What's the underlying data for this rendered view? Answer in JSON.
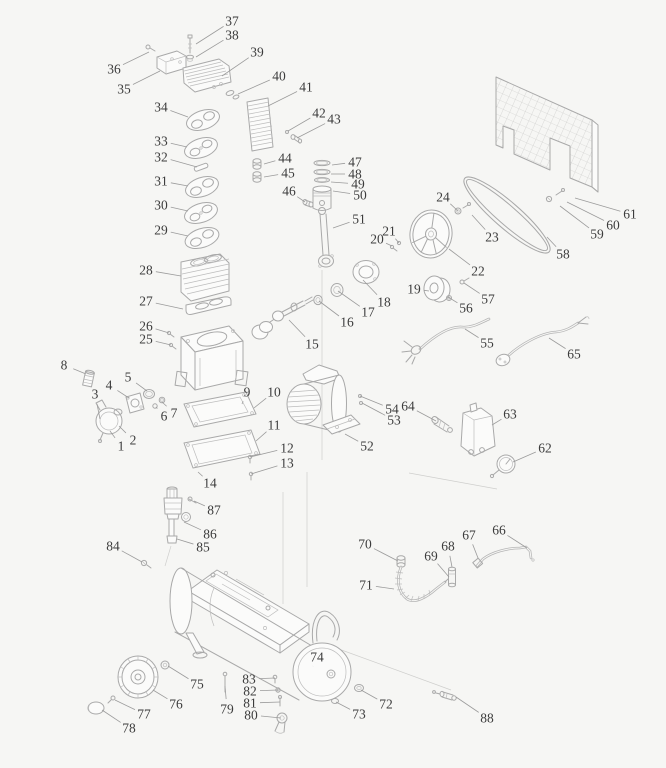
{
  "figure": {
    "kind": "exploded-parts-diagram",
    "background_color": "#f6f6f4",
    "line_color": "#a9a9a9",
    "label_color": "#3c3c3c",
    "leader_color": "#9b9b9b"
  },
  "labels": [
    {
      "n": "1",
      "x": 121,
      "y": 446,
      "tx": 110,
      "ty": 431
    },
    {
      "n": "2",
      "x": 133,
      "y": 440,
      "tx": 119,
      "ty": 426
    },
    {
      "n": "3",
      "x": 95,
      "y": 394,
      "tx": 100,
      "ty": 419
    },
    {
      "n": "4",
      "x": 109,
      "y": 385,
      "tx": 129,
      "ty": 398
    },
    {
      "n": "5",
      "x": 128,
      "y": 377,
      "tx": 147,
      "ty": 391
    },
    {
      "n": "6",
      "x": 164,
      "y": 416,
      "tx": 156,
      "ty": 407
    },
    {
      "n": "7",
      "x": 174,
      "y": 413,
      "tx": 162,
      "ty": 402
    },
    {
      "n": "8",
      "x": 64,
      "y": 365,
      "tx": 86,
      "ty": 374
    },
    {
      "n": "9",
      "x": 247,
      "y": 392,
      "tx": 242,
      "ty": 404
    },
    {
      "n": "10",
      "x": 274,
      "y": 392,
      "tx": 254,
      "ty": 408
    },
    {
      "n": "11",
      "x": 274,
      "y": 425,
      "tx": 256,
      "ty": 441
    },
    {
      "n": "12",
      "x": 287,
      "y": 448,
      "tx": 250,
      "ty": 457
    },
    {
      "n": "13",
      "x": 287,
      "y": 463,
      "tx": 251,
      "ty": 474
    },
    {
      "n": "14",
      "x": 210,
      "y": 483,
      "tx": 198,
      "ty": 472
    },
    {
      "n": "15",
      "x": 312,
      "y": 344,
      "tx": 289,
      "ty": 320
    },
    {
      "n": "16",
      "x": 347,
      "y": 322,
      "tx": 319,
      "ty": 301
    },
    {
      "n": "17",
      "x": 368,
      "y": 312,
      "tx": 338,
      "ty": 291
    },
    {
      "n": "18",
      "x": 384,
      "y": 302,
      "tx": 363,
      "ty": 280
    },
    {
      "n": "19",
      "x": 414,
      "y": 289,
      "tx": 429,
      "ty": 291
    },
    {
      "n": "20",
      "x": 377,
      "y": 239,
      "tx": 392,
      "ty": 246
    },
    {
      "n": "21",
      "x": 389,
      "y": 231,
      "tx": 399,
      "ty": 243
    },
    {
      "n": "22",
      "x": 478,
      "y": 271,
      "tx": 449,
      "ty": 249
    },
    {
      "n": "23",
      "x": 492,
      "y": 237,
      "tx": 472,
      "ty": 215
    },
    {
      "n": "24",
      "x": 443,
      "y": 197,
      "tx": 458,
      "ty": 211
    },
    {
      "n": "25",
      "x": 146,
      "y": 339,
      "tx": 171,
      "ty": 345
    },
    {
      "n": "26",
      "x": 146,
      "y": 326,
      "tx": 169,
      "ty": 333
    },
    {
      "n": "27",
      "x": 146,
      "y": 301,
      "tx": 183,
      "ty": 309
    },
    {
      "n": "28",
      "x": 146,
      "y": 270,
      "tx": 181,
      "ty": 276
    },
    {
      "n": "29",
      "x": 161,
      "y": 230,
      "tx": 188,
      "ty": 236
    },
    {
      "n": "30",
      "x": 161,
      "y": 205,
      "tx": 188,
      "ty": 211
    },
    {
      "n": "31",
      "x": 161,
      "y": 181,
      "tx": 188,
      "ty": 186
    },
    {
      "n": "32",
      "x": 161,
      "y": 157,
      "tx": 197,
      "ty": 167
    },
    {
      "n": "33",
      "x": 161,
      "y": 141,
      "tx": 187,
      "ty": 147
    },
    {
      "n": "34",
      "x": 161,
      "y": 107,
      "tx": 188,
      "ty": 117
    },
    {
      "n": "35",
      "x": 124,
      "y": 89,
      "tx": 160,
      "ty": 71
    },
    {
      "n": "36",
      "x": 114,
      "y": 69,
      "tx": 149,
      "ty": 52
    },
    {
      "n": "37",
      "x": 232,
      "y": 21,
      "tx": 196,
      "ty": 44
    },
    {
      "n": "38",
      "x": 232,
      "y": 35,
      "tx": 196,
      "ty": 57
    },
    {
      "n": "39",
      "x": 257,
      "y": 52,
      "tx": 222,
      "ty": 76
    },
    {
      "n": "40",
      "x": 279,
      "y": 76,
      "tx": 238,
      "ty": 94
    },
    {
      "n": "41",
      "x": 306,
      "y": 87,
      "tx": 268,
      "ty": 106
    },
    {
      "n": "42",
      "x": 319,
      "y": 113,
      "tx": 288,
      "ty": 131
    },
    {
      "n": "43",
      "x": 334,
      "y": 119,
      "tx": 297,
      "ty": 138
    },
    {
      "n": "44",
      "x": 285,
      "y": 158,
      "tx": 264,
      "ty": 164
    },
    {
      "n": "45",
      "x": 288,
      "y": 173,
      "tx": 264,
      "ty": 177
    },
    {
      "n": "46",
      "x": 289,
      "y": 191,
      "tx": 305,
      "ty": 202
    },
    {
      "n": "47",
      "x": 355,
      "y": 162,
      "tx": 332,
      "ty": 165
    },
    {
      "n": "48",
      "x": 355,
      "y": 174,
      "tx": 331,
      "ty": 174
    },
    {
      "n": "49",
      "x": 358,
      "y": 184,
      "tx": 331,
      "ty": 182
    },
    {
      "n": "50",
      "x": 360,
      "y": 195,
      "tx": 333,
      "ty": 191
    },
    {
      "n": "51",
      "x": 359,
      "y": 219,
      "tx": 333,
      "ty": 228
    },
    {
      "n": "52",
      "x": 367,
      "y": 446,
      "tx": 345,
      "ty": 434
    },
    {
      "n": "53",
      "x": 394,
      "y": 420,
      "tx": 362,
      "ty": 403
    },
    {
      "n": "54",
      "x": 392,
      "y": 409,
      "tx": 360,
      "ty": 396
    },
    {
      "n": "55",
      "x": 487,
      "y": 343,
      "tx": 465,
      "ty": 329
    },
    {
      "n": "56",
      "x": 466,
      "y": 308,
      "tx": 448,
      "ty": 297
    },
    {
      "n": "57",
      "x": 488,
      "y": 299,
      "tx": 464,
      "ty": 283
    },
    {
      "n": "58",
      "x": 563,
      "y": 254,
      "tx": 547,
      "ty": 237
    },
    {
      "n": "59",
      "x": 597,
      "y": 234,
      "tx": 560,
      "ty": 206
    },
    {
      "n": "60",
      "x": 613,
      "y": 225,
      "tx": 567,
      "ty": 202
    },
    {
      "n": "61",
      "x": 630,
      "y": 214,
      "tx": 575,
      "ty": 198
    },
    {
      "n": "62",
      "x": 545,
      "y": 448,
      "tx": 513,
      "ty": 462
    },
    {
      "n": "63",
      "x": 510,
      "y": 414,
      "tx": 492,
      "ty": 425
    },
    {
      "n": "64",
      "x": 408,
      "y": 406,
      "tx": 436,
      "ty": 421
    },
    {
      "n": "65",
      "x": 574,
      "y": 354,
      "tx": 549,
      "ty": 338
    },
    {
      "n": "66",
      "x": 499,
      "y": 530,
      "tx": 527,
      "ty": 548
    },
    {
      "n": "67",
      "x": 469,
      "y": 535,
      "tx": 478,
      "ty": 558
    },
    {
      "n": "68",
      "x": 448,
      "y": 546,
      "tx": 452,
      "ty": 567
    },
    {
      "n": "69",
      "x": 431,
      "y": 556,
      "tx": 449,
      "ty": 577
    },
    {
      "n": "70",
      "x": 365,
      "y": 544,
      "tx": 398,
      "ty": 561
    },
    {
      "n": "71",
      "x": 366,
      "y": 585,
      "tx": 394,
      "ty": 589
    },
    {
      "n": "72",
      "x": 386,
      "y": 704,
      "tx": 361,
      "ty": 690
    },
    {
      "n": "73",
      "x": 359,
      "y": 714,
      "tx": 336,
      "ty": 702
    },
    {
      "n": "74",
      "x": 317,
      "y": 657,
      "tx": 313,
      "ty": 666
    },
    {
      "n": "75",
      "x": 197,
      "y": 684,
      "tx": 168,
      "ty": 666
    },
    {
      "n": "76",
      "x": 176,
      "y": 704,
      "tx": 153,
      "ty": 690
    },
    {
      "n": "77",
      "x": 144,
      "y": 714,
      "tx": 115,
      "ty": 700
    },
    {
      "n": "78",
      "x": 129,
      "y": 728,
      "tx": 102,
      "ty": 710
    },
    {
      "n": "79",
      "x": 227,
      "y": 709,
      "tx": 225,
      "ty": 686
    },
    {
      "n": "80",
      "x": 251,
      "y": 715,
      "tx": 281,
      "ty": 718
    },
    {
      "n": "81",
      "x": 250,
      "y": 703,
      "tx": 280,
      "ty": 702
    },
    {
      "n": "82",
      "x": 250,
      "y": 691,
      "tx": 278,
      "ty": 690
    },
    {
      "n": "83",
      "x": 249,
      "y": 679,
      "tx": 275,
      "ty": 678
    },
    {
      "n": "84",
      "x": 113,
      "y": 546,
      "tx": 142,
      "ty": 562
    },
    {
      "n": "85",
      "x": 203,
      "y": 547,
      "tx": 177,
      "ty": 539
    },
    {
      "n": "86",
      "x": 210,
      "y": 534,
      "tx": 184,
      "ty": 522
    },
    {
      "n": "87",
      "x": 214,
      "y": 510,
      "tx": 194,
      "ty": 501
    },
    {
      "n": "88",
      "x": 487,
      "y": 718,
      "tx": 456,
      "ty": 697
    }
  ]
}
